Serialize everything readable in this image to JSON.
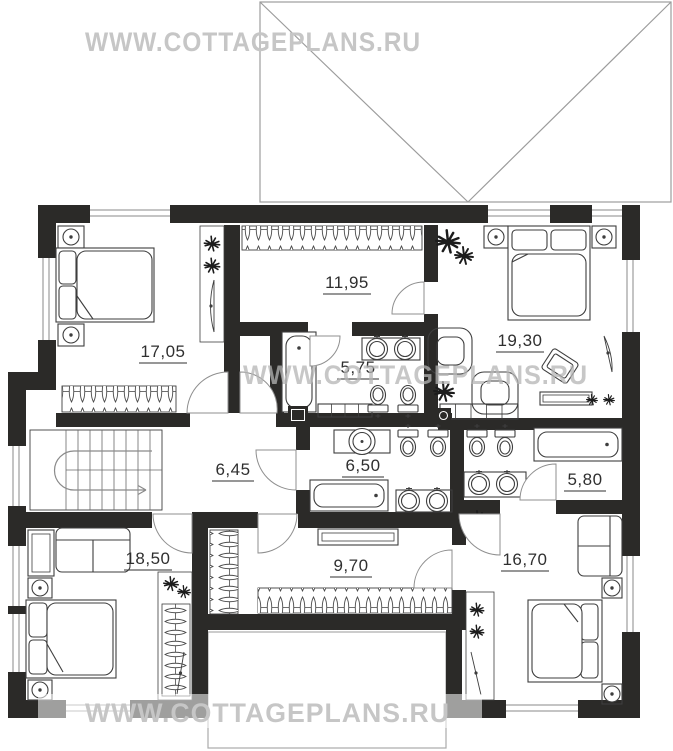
{
  "watermark": {
    "text": "WWW.COTTAGEPLANS.RU",
    "color_light": "#c6c6c6",
    "color_mid": "#b5b5b5"
  },
  "floor_plan": {
    "rooms": [
      {
        "id": "bedroom-top-left",
        "area": "17,05"
      },
      {
        "id": "dressing-room",
        "area": "11,95"
      },
      {
        "id": "bedroom-top-right",
        "area": "19,30"
      },
      {
        "id": "bathroom-top",
        "area": "5,75"
      },
      {
        "id": "stair-hall",
        "area": "6,45"
      },
      {
        "id": "bathroom-middle",
        "area": "6,50"
      },
      {
        "id": "bathroom-right",
        "area": "5,80"
      },
      {
        "id": "bedroom-bottom-left",
        "area": "18,50"
      },
      {
        "id": "corridor",
        "area": "9,70"
      },
      {
        "id": "bedroom-bottom-right",
        "area": "16,70"
      }
    ],
    "colors": {
      "wall": "#2b2a28",
      "furniture_line": "#3e3e3e",
      "roof_line": "#9c9c9c"
    }
  }
}
